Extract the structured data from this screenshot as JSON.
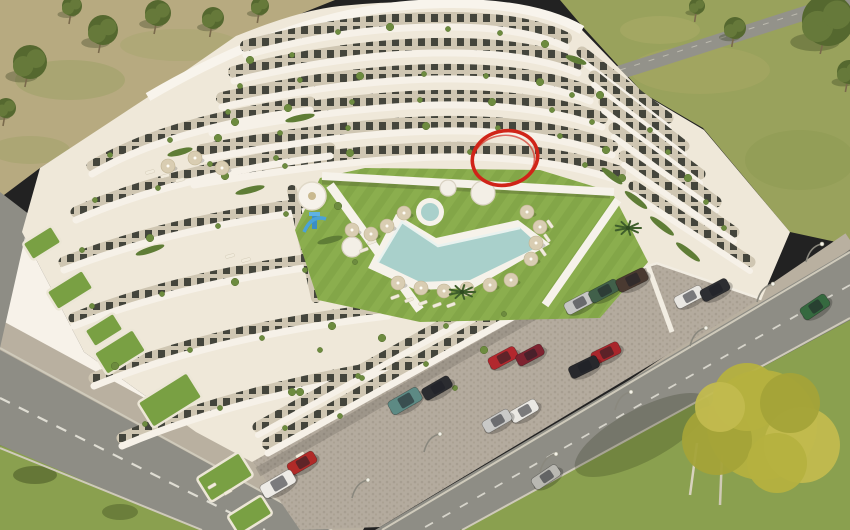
{
  "scene": {
    "kind": "aerial-3d-render-of-apartment-complex",
    "annotation": {
      "shape": "hand-drawn-ellipse",
      "color": "#d02418",
      "cx": 505,
      "cy": 158,
      "rx": 33,
      "ry": 27,
      "rot": -14
    },
    "palette": {
      "building": "#efe8d9",
      "building_white": "#f7f2e9",
      "band_shadow": "#d9d0bc",
      "window_dark": "#44453c",
      "window_bg": "#cfc6b2",
      "lawn": "#83a648",
      "lawn_stripe": "#8bae4e",
      "lawn_shade": "#6d8f3a",
      "pool": "#a9d0cb",
      "pool_rim": "#e9f2ef",
      "deck": "#f6f2ea",
      "parking": "#b4ab9e",
      "cobble_dot": "#a79e91",
      "road": "#8e8d85",
      "road_dash": "#e8e6dc",
      "sidewalk": "#b9b0a0",
      "curb": "#d3cec0",
      "field_dry": "#b7aa80",
      "field_green": "#99a25c",
      "grass_corner": "#8aa04f",
      "tree_dark": "#55682f",
      "tree_dark2": "#66793a",
      "tree_yellow": "#b5b13f",
      "tree_yellow2": "#a4a338",
      "tree_yellow3": "#c2bb4e",
      "shrub": "#6d8b3f",
      "hedge": "#5f7d36",
      "umbrella": "#d9cdb2",
      "lounger": "#f1ebdc",
      "wall_white": "#f2ede2",
      "slide_blue": "#4aa3d8",
      "shadow": "rgba(40,45,25,0.28)"
    },
    "cars": [
      {
        "x": 579,
        "y": 303,
        "a": -28,
        "c": "#c6c6c4",
        "l": 30,
        "w": 13
      },
      {
        "x": 604,
        "y": 291,
        "a": -28,
        "c": "#41604a",
        "l": 31,
        "w": 13
      },
      {
        "x": 632,
        "y": 280,
        "a": -26,
        "c": "#4a3a31",
        "l": 32,
        "w": 14
      },
      {
        "x": 689,
        "y": 297,
        "a": -28,
        "c": "#e9e7e2",
        "l": 30,
        "w": 13
      },
      {
        "x": 715,
        "y": 290,
        "a": -28,
        "c": "#2d2e32",
        "l": 30,
        "w": 13
      },
      {
        "x": 606,
        "y": 353,
        "a": -26,
        "c": "#a8262c",
        "l": 30,
        "w": 13
      },
      {
        "x": 584,
        "y": 367,
        "a": -26,
        "c": "#27282c",
        "l": 31,
        "w": 13
      },
      {
        "x": 405,
        "y": 401,
        "a": -30,
        "c": "#5d8a84",
        "l": 34,
        "w": 15
      },
      {
        "x": 437,
        "y": 388,
        "a": -30,
        "c": "#2b2c30",
        "l": 31,
        "w": 13
      },
      {
        "x": 503,
        "y": 358,
        "a": -28,
        "c": "#b2282e",
        "l": 30,
        "w": 13
      },
      {
        "x": 530,
        "y": 355,
        "a": -28,
        "c": "#7e2330",
        "l": 29,
        "w": 12
      },
      {
        "x": 524,
        "y": 411,
        "a": -30,
        "c": "#eae8e3",
        "l": 30,
        "w": 13
      },
      {
        "x": 497,
        "y": 421,
        "a": -30,
        "c": "#c9c9c7",
        "l": 30,
        "w": 13
      },
      {
        "x": 302,
        "y": 463,
        "a": -30,
        "c": "#b02a28",
        "l": 30,
        "w": 13
      },
      {
        "x": 278,
        "y": 484,
        "a": -30,
        "c": "#edebe6",
        "l": 36,
        "w": 15
      },
      {
        "x": 815,
        "y": 307,
        "a": -34,
        "c": "#35693f",
        "l": 30,
        "w": 14
      },
      {
        "x": 546,
        "y": 477,
        "a": -34,
        "c": "#b9b8b2",
        "l": 30,
        "w": 13
      }
    ],
    "umbrellas": [
      [
        398,
        283
      ],
      [
        421,
        288
      ],
      [
        444,
        291
      ],
      [
        467,
        289
      ],
      [
        490,
        285
      ],
      [
        511,
        280
      ],
      [
        531,
        259
      ],
      [
        536,
        243
      ],
      [
        540,
        227
      ],
      [
        527,
        212
      ],
      [
        387,
        226
      ],
      [
        371,
        234
      ],
      [
        404,
        213
      ],
      [
        352,
        230
      ],
      [
        168,
        166
      ],
      [
        195,
        158
      ],
      [
        222,
        168
      ]
    ],
    "loungers": [
      [
        395,
        297,
        -20
      ],
      [
        409,
        300,
        -20
      ],
      [
        423,
        303,
        -20
      ],
      [
        437,
        305,
        -20
      ],
      [
        451,
        305,
        -20
      ],
      [
        372,
        242,
        -20
      ],
      [
        364,
        250,
        -20
      ],
      [
        543,
        252,
        55
      ],
      [
        547,
        238,
        55
      ],
      [
        550,
        224,
        55
      ],
      [
        150,
        172,
        -15
      ],
      [
        165,
        176,
        -15
      ],
      [
        180,
        180,
        -15
      ],
      [
        230,
        256,
        -15
      ],
      [
        246,
        260,
        -15
      ],
      [
        212,
        486,
        -30
      ],
      [
        228,
        492,
        -30
      ],
      [
        300,
        455,
        -30
      ]
    ],
    "planters": [
      {
        "x": 448,
        "y": 188,
        "r": 8
      },
      {
        "x": 483,
        "y": 193,
        "r": 12
      },
      {
        "x": 352,
        "y": 247,
        "r": 10
      }
    ],
    "shrubs": [
      [
        250,
        60
      ],
      [
        292,
        55
      ],
      [
        338,
        32
      ],
      [
        390,
        27
      ],
      [
        448,
        29
      ],
      [
        500,
        33
      ],
      [
        545,
        44
      ],
      [
        240,
        86
      ],
      [
        300,
        80
      ],
      [
        360,
        76
      ],
      [
        424,
        74
      ],
      [
        486,
        76
      ],
      [
        540,
        82
      ],
      [
        572,
        95
      ],
      [
        228,
        112
      ],
      [
        288,
        108
      ],
      [
        352,
        102
      ],
      [
        420,
        100
      ],
      [
        492,
        102
      ],
      [
        552,
        110
      ],
      [
        592,
        122
      ],
      [
        218,
        138
      ],
      [
        280,
        133
      ],
      [
        348,
        128
      ],
      [
        426,
        126
      ],
      [
        498,
        128
      ],
      [
        560,
        136
      ],
      [
        606,
        150
      ],
      [
        210,
        164
      ],
      [
        276,
        158
      ],
      [
        350,
        153
      ],
      [
        470,
        152
      ],
      [
        585,
        165
      ],
      [
        622,
        178
      ],
      [
        650,
        130
      ],
      [
        668,
        152
      ],
      [
        688,
        178
      ],
      [
        706,
        202
      ],
      [
        724,
        228
      ],
      [
        600,
        95
      ],
      [
        110,
        155
      ],
      [
        170,
        140
      ],
      [
        235,
        122
      ],
      [
        95,
        200
      ],
      [
        158,
        188
      ],
      [
        225,
        176
      ],
      [
        285,
        166
      ],
      [
        82,
        250
      ],
      [
        150,
        238
      ],
      [
        218,
        226
      ],
      [
        286,
        214
      ],
      [
        338,
        206
      ],
      [
        92,
        306
      ],
      [
        162,
        294
      ],
      [
        235,
        282
      ],
      [
        305,
        270
      ],
      [
        355,
        262
      ],
      [
        115,
        366
      ],
      [
        190,
        350
      ],
      [
        262,
        338
      ],
      [
        332,
        326
      ],
      [
        145,
        424
      ],
      [
        220,
        408
      ],
      [
        292,
        392
      ],
      [
        358,
        376
      ],
      [
        320,
        350
      ],
      [
        382,
        338
      ],
      [
        446,
        326
      ],
      [
        504,
        314
      ],
      [
        300,
        392
      ],
      [
        362,
        378
      ],
      [
        426,
        364
      ],
      [
        484,
        350
      ],
      [
        285,
        428
      ],
      [
        340,
        416
      ],
      [
        398,
        402
      ],
      [
        455,
        388
      ]
    ],
    "hedges": [
      {
        "x": 612,
        "y": 176,
        "w": 26,
        "r": 38
      },
      {
        "x": 636,
        "y": 200,
        "w": 28,
        "r": 38
      },
      {
        "x": 662,
        "y": 226,
        "w": 30,
        "r": 38
      },
      {
        "x": 688,
        "y": 252,
        "w": 30,
        "r": 38
      },
      {
        "x": 576,
        "y": 60,
        "w": 22,
        "r": 20
      },
      {
        "x": 300,
        "y": 118,
        "w": 30,
        "r": -12
      },
      {
        "x": 180,
        "y": 152,
        "w": 26,
        "r": -15
      },
      {
        "x": 250,
        "y": 190,
        "w": 30,
        "r": -14
      },
      {
        "x": 330,
        "y": 240,
        "w": 26,
        "r": -14
      },
      {
        "x": 150,
        "y": 250,
        "w": 30,
        "r": -18
      }
    ],
    "grass_patches": [
      {
        "x": 120,
        "y": 352,
        "w": 46,
        "h": 26
      },
      {
        "x": 170,
        "y": 400,
        "w": 58,
        "h": 30
      },
      {
        "x": 225,
        "y": 477,
        "w": 50,
        "h": 28
      },
      {
        "x": 42,
        "y": 243,
        "w": 34,
        "h": 20
      },
      {
        "x": 70,
        "y": 290,
        "w": 42,
        "h": 22
      },
      {
        "x": 104,
        "y": 330,
        "w": 34,
        "h": 20
      },
      {
        "x": 250,
        "y": 515,
        "w": 40,
        "h": 22
      }
    ],
    "trees_topleft": [
      {
        "x": 30,
        "y": 62,
        "r": 17
      },
      {
        "x": 103,
        "y": 30,
        "r": 15
      },
      {
        "x": 158,
        "y": 13,
        "r": 13
      },
      {
        "x": 213,
        "y": 18,
        "r": 11
      },
      {
        "x": 260,
        "y": 6,
        "r": 9
      },
      {
        "x": 6,
        "y": 108,
        "r": 10
      },
      {
        "x": 72,
        "y": 6,
        "r": 10
      }
    ],
    "trees_topright": [
      {
        "x": 735,
        "y": 28,
        "r": 11
      },
      {
        "x": 828,
        "y": 20,
        "r": 26
      },
      {
        "x": 849,
        "y": 72,
        "r": 12
      },
      {
        "x": 697,
        "y": 6,
        "r": 8
      }
    ],
    "big_tree": {
      "x": 762,
      "y": 425,
      "lobes": [
        [
          0,
          0,
          55
        ],
        [
          -45,
          15,
          35
        ],
        [
          40,
          20,
          38
        ],
        [
          -15,
          -28,
          34
        ],
        [
          28,
          -22,
          30
        ],
        [
          -42,
          -18,
          25
        ],
        [
          15,
          38,
          30
        ]
      ]
    },
    "palms": [
      [
        462,
        292
      ],
      [
        628,
        228
      ]
    ],
    "lamps": [
      [
        757,
        302
      ],
      [
        690,
        346
      ],
      [
        615,
        410
      ],
      [
        540,
        472
      ],
      [
        424,
        452
      ],
      [
        352,
        498
      ],
      [
        806,
        262
      ]
    ]
  }
}
